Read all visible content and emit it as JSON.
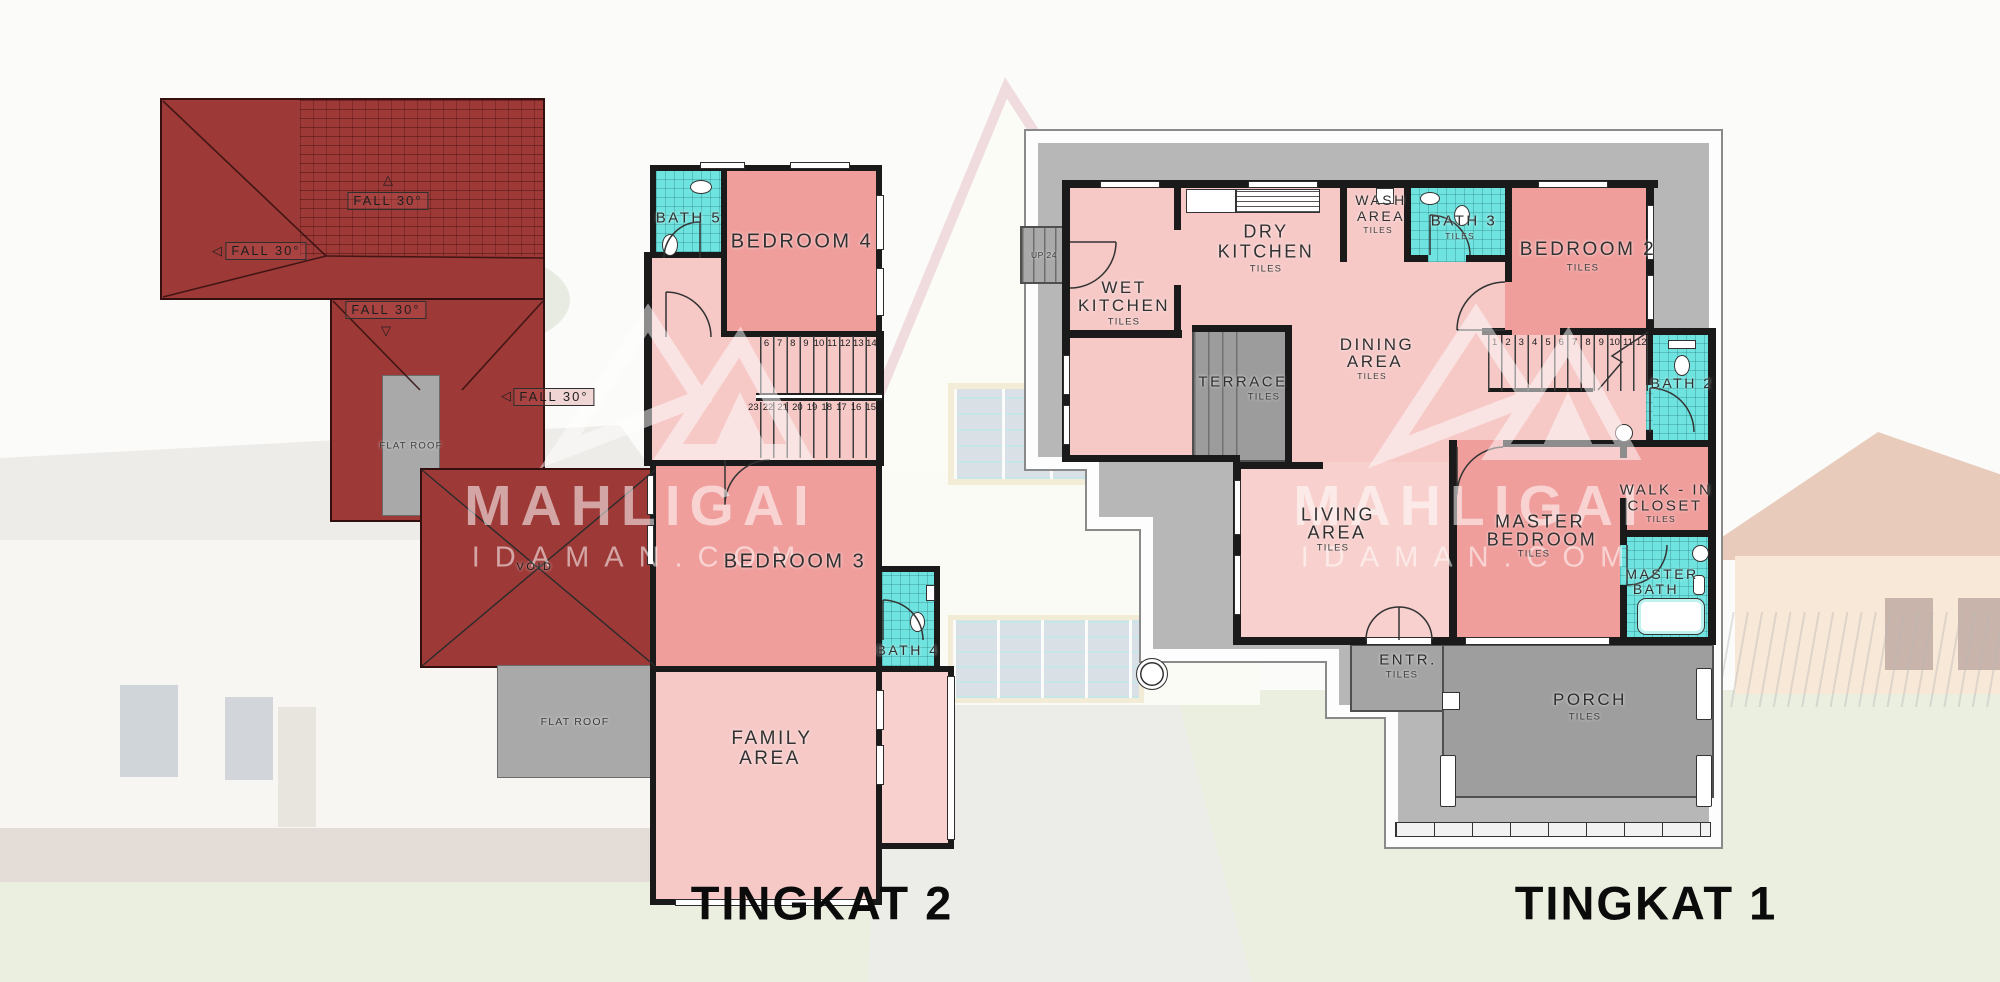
{
  "watermark": {
    "brand": "MAHLIGAI",
    "site": "IDAMAN.COM"
  },
  "common": {
    "tiles": "TILES",
    "fall": "FALL 30°",
    "flat_roof": "FLAT ROOF",
    "void": "VOID",
    "up_label": "UP 24"
  },
  "floor2": {
    "title": "TINGKAT 2",
    "bath5": "BATH 5",
    "bedroom4": "BEDROOM 4",
    "bedroom3": "BEDROOM 3",
    "bath4": "BATH 4",
    "family1": "FAMILY",
    "family2": "AREA",
    "stairs_top": [
      "6",
      "7",
      "8",
      "9",
      "10",
      "11",
      "12",
      "13",
      "14"
    ],
    "stairs_bottom": [
      "23",
      "22",
      "21",
      "20",
      "19",
      "18",
      "17",
      "16",
      "15"
    ]
  },
  "floor1": {
    "title": "TINGKAT 1",
    "wet1": "WET",
    "wet2": "KITCHEN",
    "dry1": "DRY",
    "dry2": "KITCHEN",
    "wash1": "WASH",
    "wash2": "AREA",
    "bath3": "BATH 3",
    "bedroom2": "BEDROOM 2",
    "terrace": "TERRACE",
    "dining1": "DINING",
    "dining2": "AREA",
    "bath2": "BATH 2",
    "living1": "LIVING",
    "living2": "AREA",
    "master1": "MASTER",
    "master2": "BEDROOM",
    "walkin1": "WALK - IN",
    "walkin2": "CLOSET",
    "mbath1": "MASTER",
    "mbath2": "BATH",
    "entr": "ENTR.",
    "porch": "PORCH",
    "stairs": [
      "1",
      "2",
      "3",
      "4",
      "5",
      "6",
      "7",
      "8",
      "9",
      "10",
      "11",
      "12"
    ]
  },
  "colors": {
    "roof_red": "#9d3937",
    "bedroom_pink": "#ef9e9c",
    "hall_pink": "#f6c9c7",
    "bath_cyan": "#6fe3df",
    "paving_gray": "#9c9c9c"
  }
}
